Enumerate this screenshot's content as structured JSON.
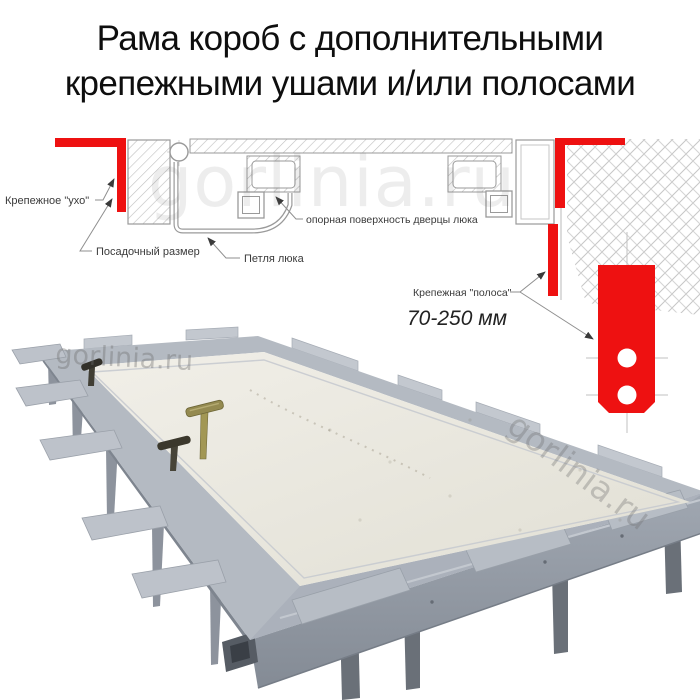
{
  "title": {
    "line1": "Рама короб с дополнительными",
    "line2": "крепежными ушами и/или полосами"
  },
  "diagram": {
    "labels": {
      "ear": "Крепежное \"ухо\"",
      "seat_size": "Посадочный размер",
      "hinge": "Петля люка",
      "support_surface": "опорная поверхность дверцы люка",
      "strip": "Крепежная \"полоса\"",
      "strip_range": "70-250 мм"
    },
    "colors": {
      "accent_red": "#ee1111",
      "drawing_line": "#9a9a9a",
      "hatch_line": "#c4c4c4",
      "label_text": "#3a3a3a"
    }
  },
  "photo": {
    "colors": {
      "panel": "#eae8e0",
      "frame_flange": "#b4bac2",
      "frame_skirt": "#8d939d",
      "leg": "#6a7078",
      "handle_brass": "#948a50",
      "handle_dark": "#3b382c"
    }
  },
  "watermark": {
    "diagram": "gorlinia.ru",
    "photo_left": "gorlinia.ru",
    "photo_right": "gorlinia.ru"
  }
}
